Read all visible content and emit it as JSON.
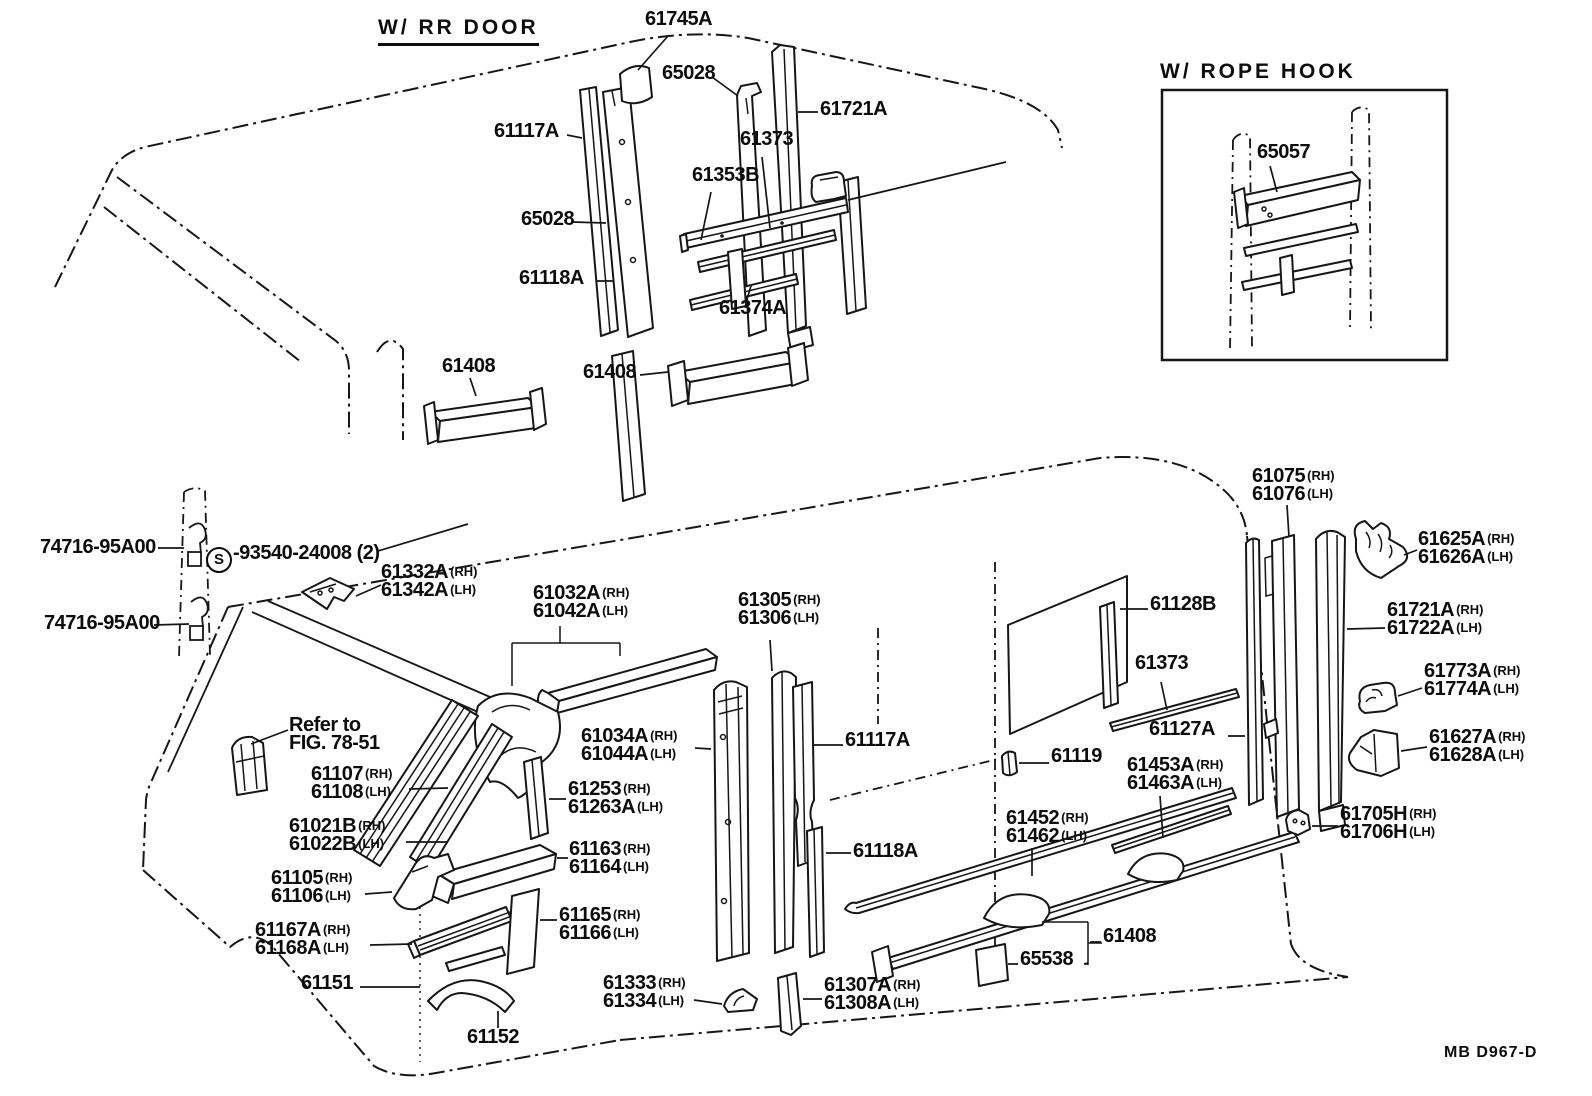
{
  "doc": {
    "figure_code": "MB D967-D"
  },
  "canvas": {
    "background": "#ffffff",
    "ink": "#161616"
  },
  "sections": {
    "rr_door": {
      "title": "W/ RR  DOOR"
    },
    "rope_hook": {
      "title": "W/ ROPE  HOOK"
    }
  },
  "labels": [
    {
      "id": "61745A",
      "x": 645,
      "y": 10,
      "lines": [
        {
          "n": "61745A"
        }
      ]
    },
    {
      "id": "65028-top",
      "x": 662,
      "y": 64,
      "lines": [
        {
          "n": "65028"
        }
      ]
    },
    {
      "id": "61721A-top",
      "x": 820,
      "y": 100,
      "lines": [
        {
          "n": "61721A"
        }
      ]
    },
    {
      "id": "61117A-top",
      "x": 494,
      "y": 122,
      "lines": [
        {
          "n": "61117A"
        }
      ]
    },
    {
      "id": "61373-top",
      "x": 740,
      "y": 130,
      "lines": [
        {
          "n": "61373"
        }
      ]
    },
    {
      "id": "61353B",
      "x": 692,
      "y": 166,
      "lines": [
        {
          "n": "61353B"
        }
      ]
    },
    {
      "id": "65028-side",
      "x": 521,
      "y": 210,
      "lines": [
        {
          "n": "65028"
        }
      ]
    },
    {
      "id": "61118A-top",
      "x": 519,
      "y": 269,
      "lines": [
        {
          "n": "61118A"
        }
      ]
    },
    {
      "id": "61374A",
      "x": 719,
      "y": 299,
      "lines": [
        {
          "n": "61374A"
        }
      ]
    },
    {
      "id": "61408-front",
      "x": 442,
      "y": 357,
      "lines": [
        {
          "n": "61408"
        }
      ]
    },
    {
      "id": "61408-mid",
      "x": 583,
      "y": 363,
      "lines": [
        {
          "n": "61408"
        }
      ]
    },
    {
      "id": "65057",
      "x": 1257,
      "y": 143,
      "lines": [
        {
          "n": "65057"
        }
      ]
    },
    {
      "id": "74716-upper",
      "x": 40,
      "y": 538,
      "lines": [
        {
          "n": "74716-95A00"
        }
      ]
    },
    {
      "id": "93540",
      "x": 206,
      "y": 544,
      "lines": [
        {
          "c": "S",
          "n": "-93540-24008 (2)"
        }
      ]
    },
    {
      "id": "74716-lower",
      "x": 44,
      "y": 614,
      "lines": [
        {
          "n": "74716-95A00"
        }
      ]
    },
    {
      "id": "61332A",
      "x": 381,
      "y": 563,
      "lines": [
        {
          "n": "61332A",
          "s": "(RH)"
        },
        {
          "n": "61342A",
          "s": "(LH)"
        }
      ]
    },
    {
      "id": "61032A",
      "x": 533,
      "y": 584,
      "lines": [
        {
          "n": "61032A",
          "s": "(RH)"
        },
        {
          "n": "61042A",
          "s": "(LH)"
        }
      ]
    },
    {
      "id": "61305",
      "x": 738,
      "y": 591,
      "lines": [
        {
          "n": "61305",
          "s": "(RH)"
        },
        {
          "n": "61306",
          "s": "(LH)"
        }
      ]
    },
    {
      "id": "refer-fig",
      "x": 289,
      "y": 716,
      "lines": [
        {
          "n": "Refer to"
        },
        {
          "n": "FIG. 78-51"
        }
      ]
    },
    {
      "id": "61107",
      "x": 311,
      "y": 765,
      "lines": [
        {
          "n": "61107",
          "s": "(RH)"
        },
        {
          "n": "61108",
          "s": "(LH)"
        }
      ]
    },
    {
      "id": "61021B",
      "x": 289,
      "y": 817,
      "lines": [
        {
          "n": "61021B",
          "s": "(RH)"
        },
        {
          "n": "61022B",
          "s": "(LH)"
        }
      ]
    },
    {
      "id": "61105",
      "x": 271,
      "y": 869,
      "lines": [
        {
          "n": "61105",
          "s": "(RH)"
        },
        {
          "n": "61106",
          "s": "(LH)"
        }
      ]
    },
    {
      "id": "61167A",
      "x": 255,
      "y": 921,
      "lines": [
        {
          "n": "61167A",
          "s": "(RH)"
        },
        {
          "n": "61168A",
          "s": "(LH)"
        }
      ]
    },
    {
      "id": "61151",
      "x": 301,
      "y": 974,
      "lines": [
        {
          "n": "61151"
        }
      ]
    },
    {
      "id": "61152",
      "x": 467,
      "y": 1028,
      "lines": [
        {
          "n": "61152"
        }
      ]
    },
    {
      "id": "61034A",
      "x": 581,
      "y": 727,
      "lines": [
        {
          "n": "61034A",
          "s": "(RH)"
        },
        {
          "n": "61044A",
          "s": "(LH)"
        }
      ]
    },
    {
      "id": "61253",
      "x": 568,
      "y": 780,
      "lines": [
        {
          "n": "61253",
          "s": "(RH)"
        },
        {
          "n": "61263A",
          "s": "(LH)"
        }
      ]
    },
    {
      "id": "61163",
      "x": 569,
      "y": 840,
      "lines": [
        {
          "n": "61163",
          "s": "(RH)"
        },
        {
          "n": "61164",
          "s": "(LH)"
        }
      ]
    },
    {
      "id": "61165",
      "x": 559,
      "y": 906,
      "lines": [
        {
          "n": "61165",
          "s": "(RH)"
        },
        {
          "n": "61166",
          "s": "(LH)"
        }
      ]
    },
    {
      "id": "61117A-low",
      "x": 845,
      "y": 731,
      "lines": [
        {
          "n": "61117A"
        }
      ]
    },
    {
      "id": "61118A-low",
      "x": 853,
      "y": 842,
      "lines": [
        {
          "n": "61118A"
        }
      ]
    },
    {
      "id": "61119",
      "x": 1051,
      "y": 747,
      "lines": [
        {
          "n": "61119"
        }
      ]
    },
    {
      "id": "61333",
      "x": 603,
      "y": 974,
      "lines": [
        {
          "n": "61333",
          "s": "(RH)"
        },
        {
          "n": "61334",
          "s": "(LH)"
        }
      ]
    },
    {
      "id": "61307A",
      "x": 824,
      "y": 976,
      "lines": [
        {
          "n": "61307A",
          "s": "(RH)"
        },
        {
          "n": "61308A",
          "s": "(LH)"
        }
      ]
    },
    {
      "id": "65538",
      "x": 1020,
      "y": 950,
      "lines": [
        {
          "n": "65538"
        }
      ]
    },
    {
      "id": "61408-rocker",
      "x": 1103,
      "y": 927,
      "lines": [
        {
          "n": "61408"
        }
      ]
    },
    {
      "id": "61452",
      "x": 1006,
      "y": 809,
      "lines": [
        {
          "n": "61452",
          "s": "(RH)"
        },
        {
          "n": "61462",
          "s": "(LH)"
        }
      ]
    },
    {
      "id": "61453A",
      "x": 1127,
      "y": 756,
      "lines": [
        {
          "n": "61453A",
          "s": "(RH)"
        },
        {
          "n": "61463A",
          "s": "(LH)"
        }
      ]
    },
    {
      "id": "61075",
      "x": 1252,
      "y": 467,
      "lines": [
        {
          "n": "61075",
          "s": "(RH)"
        },
        {
          "n": "61076",
          "s": "(LH)"
        }
      ]
    },
    {
      "id": "61128B",
      "x": 1150,
      "y": 595,
      "lines": [
        {
          "n": "61128B"
        }
      ]
    },
    {
      "id": "61373-rear",
      "x": 1135,
      "y": 654,
      "lines": [
        {
          "n": "61373"
        }
      ]
    },
    {
      "id": "61127A",
      "x": 1149,
      "y": 720,
      "lines": [
        {
          "n": "61127A"
        }
      ]
    },
    {
      "id": "61625A",
      "x": 1418,
      "y": 530,
      "lines": [
        {
          "n": "61625A",
          "s": "(RH)"
        },
        {
          "n": "61626A",
          "s": "(LH)"
        }
      ]
    },
    {
      "id": "61721A-rear",
      "x": 1387,
      "y": 601,
      "lines": [
        {
          "n": "61721A",
          "s": "(RH)"
        },
        {
          "n": "61722A",
          "s": "(LH)"
        }
      ]
    },
    {
      "id": "61773A",
      "x": 1424,
      "y": 662,
      "lines": [
        {
          "n": "61773A",
          "s": "(RH)"
        },
        {
          "n": "61774A",
          "s": "(LH)"
        }
      ]
    },
    {
      "id": "61627A",
      "x": 1429,
      "y": 728,
      "lines": [
        {
          "n": "61627A",
          "s": "(RH)"
        },
        {
          "n": "61628A",
          "s": "(LH)"
        }
      ]
    },
    {
      "id": "61705H",
      "x": 1340,
      "y": 805,
      "lines": [
        {
          "n": "61705H",
          "s": "(RH)"
        },
        {
          "n": "61706H",
          "s": "(LH)"
        }
      ]
    }
  ]
}
